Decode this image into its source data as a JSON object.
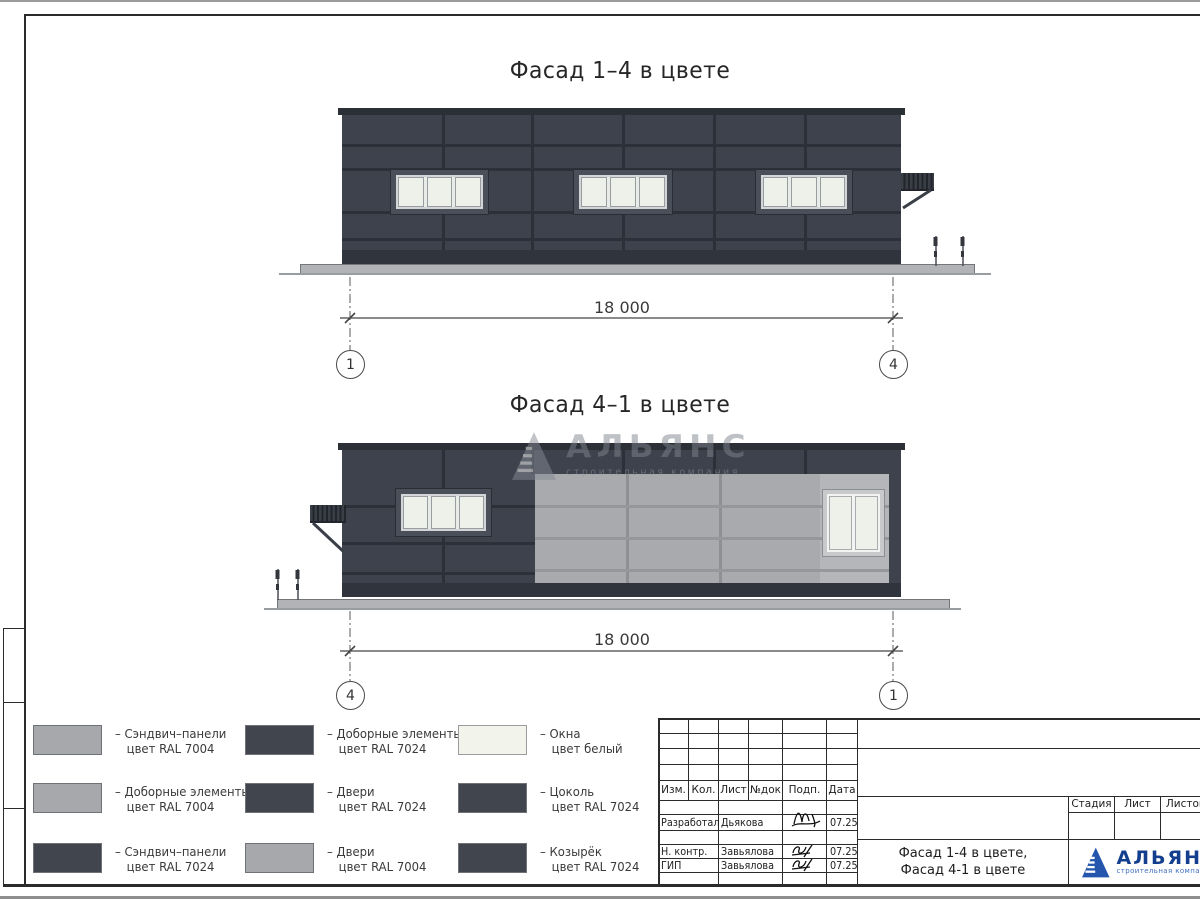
{
  "titles": {
    "facade1": "Фасад 1–4 в цвете",
    "facade2": "Фасад 4–1 в цвете"
  },
  "dims": {
    "facade1": {
      "value": "18 000",
      "axis_left": "1",
      "axis_right": "4"
    },
    "facade2": {
      "value": "18 000",
      "axis_left": "4",
      "axis_right": "1"
    }
  },
  "watermark": {
    "name": "АЛЬЯНС",
    "subtitle": "строительная компания"
  },
  "legend": {
    "items": [
      {
        "swatch": "#a6a8ab",
        "label": "– Сэндвич–панели",
        "color": "цвет RAL 7004"
      },
      {
        "swatch": "#41454e",
        "label": "– Доборные элементы",
        "color": "цвет RAL 7024"
      },
      {
        "swatch": "#f2f4ec",
        "label": "– Окна",
        "color": "цвет белый"
      },
      {
        "swatch": "#a6a8ab",
        "label": "– Доборные элементы",
        "color": "цвет RAL 7004"
      },
      {
        "swatch": "#41454e",
        "label": "– Двери",
        "color": "цвет RAL 7024"
      },
      {
        "swatch": "#41454e",
        "label": "– Цоколь",
        "color": "цвет RAL 7024"
      },
      {
        "swatch": "#41454e",
        "label": "– Сэндвич–панели",
        "color": "цвет RAL 7024"
      },
      {
        "swatch": "#a6a8ab",
        "label": "– Двери",
        "color": "цвет RAL 7004"
      },
      {
        "swatch": "#41454e",
        "label": "– Козырёк",
        "color": "цвет RAL 7024"
      }
    ]
  },
  "titleblock": {
    "header_cols": [
      "Изм.",
      "Кол.",
      "Лист",
      "№док",
      "Подп.",
      "Дата"
    ],
    "rows": [
      {
        "role": "Разработал",
        "name": "Дьякова",
        "date": "07.25"
      },
      {
        "role": "Н. контр.",
        "name": "Завьялова",
        "date": "07.25"
      },
      {
        "role": "ГИП",
        "name": "Завьялова",
        "date": "07.25"
      }
    ],
    "stage_cols": [
      "Стадия",
      "Лист",
      "Листов"
    ],
    "doc_title_line1": "Фасад 1-4 в цвете,",
    "doc_title_line2": "Фасад 4-1 в цвете",
    "logo": {
      "name": "АЛЬЯНС",
      "subtitle": "строительная компания"
    }
  },
  "colors": {
    "ral7024_panel": "#3e424c",
    "ral7004_panel": "#a8aaad",
    "window_white": "#eef1e9",
    "logo_blue": "#143f8f",
    "line": "#2b2b2b"
  }
}
